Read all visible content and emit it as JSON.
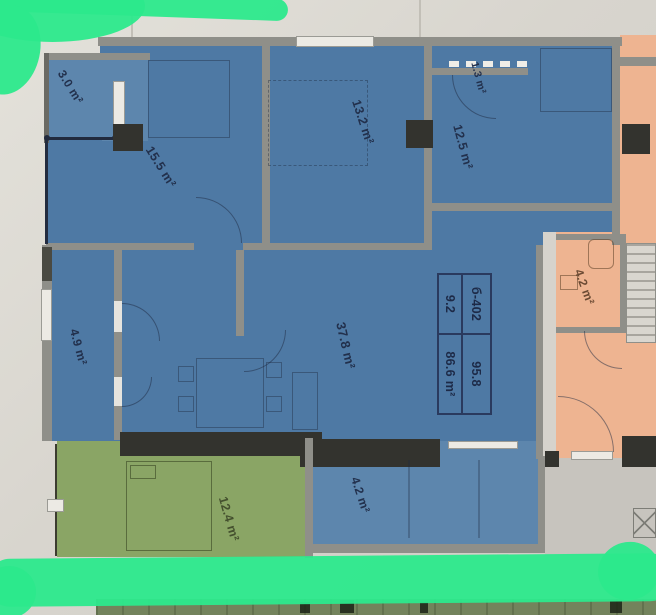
{
  "plan": {
    "type": "apartment-floor-plan-photo",
    "unit_table": {
      "cells": [
        [
          "б-402",
          "95.8"
        ],
        [
          "9.2",
          "86.6 m²"
        ]
      ]
    },
    "rooms": [
      {
        "name": "balcony-top-left",
        "area": "3.0 m²"
      },
      {
        "name": "bedroom-left",
        "area": "15.5 m²"
      },
      {
        "name": "bedroom-middle",
        "area": "13.2 m²"
      },
      {
        "name": "closet-top-right",
        "area": "1.3 m²"
      },
      {
        "name": "bedroom-right",
        "area": "12.5 m²"
      },
      {
        "name": "hallway-left",
        "area": "4.9 m²"
      },
      {
        "name": "living-room",
        "area": "37.8 m²"
      },
      {
        "name": "balcony-bottom",
        "area": "4.2 m²"
      },
      {
        "name": "neighbor-room-green",
        "area": "12.4 m²"
      },
      {
        "name": "neighbor-bathroom-orange",
        "area": "4.2 m²"
      }
    ],
    "colors": {
      "apartment_blue": "#4e79a4",
      "apartment_blue_light": "#5d86ad",
      "neighbor_green": "#8aa565",
      "neighbor_orange": "#eeb491",
      "highlighter_green": "#2ce98c",
      "paper": "#d8d5ce",
      "paper_2": "#e4e2db",
      "wall_gray": "#8f8f89",
      "wall_dark": "#33332e",
      "floor_gray": "#c7c4be",
      "label_navy": "#22304c",
      "label_green": "#44502e",
      "label_orange": "#6b4a33"
    }
  }
}
